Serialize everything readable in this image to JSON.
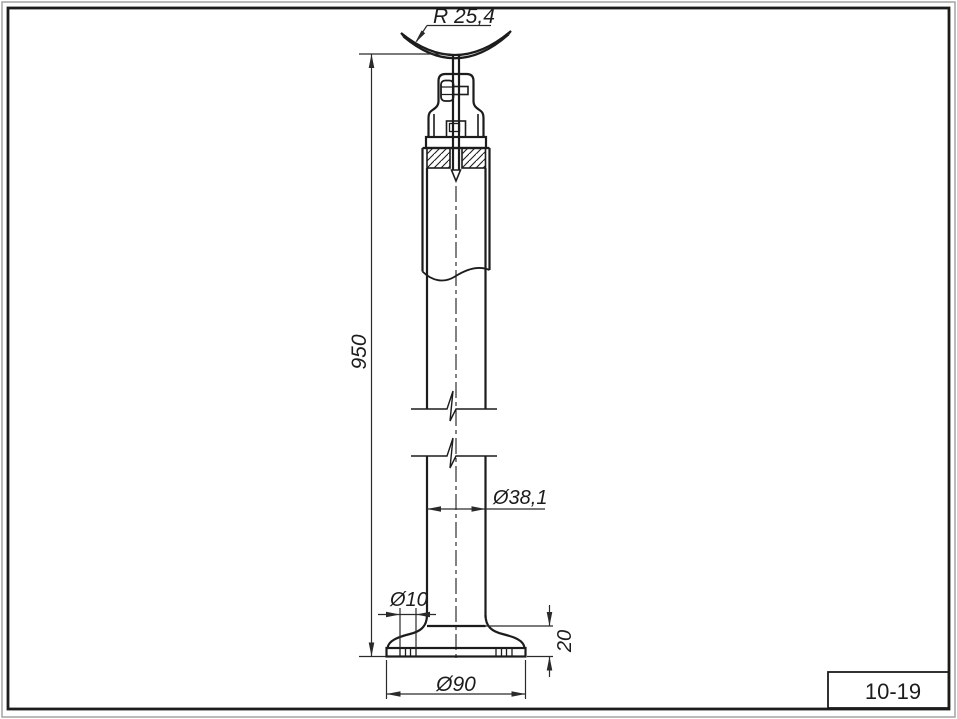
{
  "title_block": {
    "part_number": "10-19"
  },
  "dimensions": {
    "saddle_radius": "R 25,4",
    "overall_height": "950",
    "tube_diameter": "Ø38,1",
    "hole_diameter": "Ø10",
    "base_height": "20",
    "base_diameter": "Ø90"
  },
  "colors": {
    "line": "#1c1c1c",
    "thin_line": "#2a2a2a",
    "frame_gray": "#a3a3a3",
    "background": "#ffffff"
  }
}
